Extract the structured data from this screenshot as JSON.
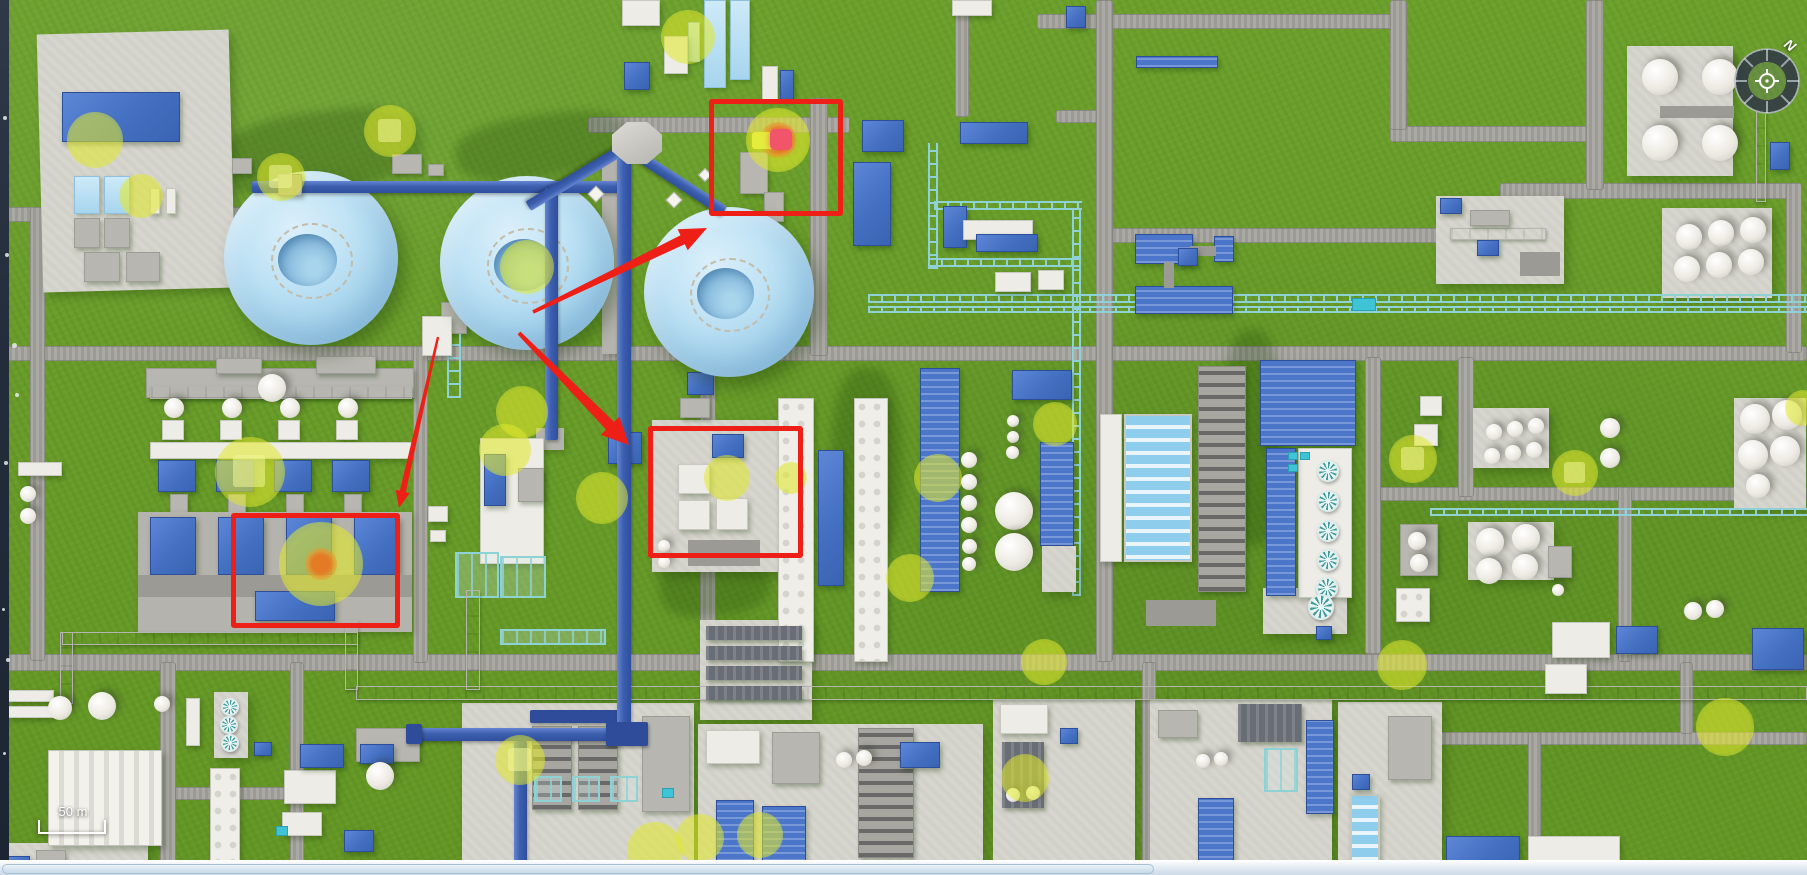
{
  "map": {
    "scale": {
      "label": "50 m"
    },
    "compass": {
      "north_label": "N"
    }
  },
  "colors": {
    "annotation_red": "#ee1f16",
    "sensor_yellow": "#e0e82c",
    "alarm_orange": "#ec731e",
    "alarm_core_red": "#f0556a",
    "sphere_blue": "#a3d2ec",
    "building_blue": "#4470c2",
    "grass_green": "#689b2b"
  },
  "annotations": {
    "rects": [
      {
        "x": 709,
        "y": 99,
        "w": 134,
        "h": 117
      },
      {
        "x": 648,
        "y": 426,
        "w": 155,
        "h": 132
      },
      {
        "x": 231,
        "y": 513,
        "w": 169,
        "h": 115
      }
    ],
    "arrows": [
      {
        "x1": 533,
        "y1": 312,
        "x2": 707,
        "y2": 228,
        "w": 8
      },
      {
        "x1": 519,
        "y1": 333,
        "x2": 629,
        "y2": 445,
        "w": 9
      },
      {
        "x1": 438,
        "y1": 337,
        "x2": 399,
        "y2": 508,
        "w": 5
      }
    ]
  },
  "alarms": [
    {
      "x": 778,
      "y": 140,
      "r": 32,
      "orange_r": 18,
      "core": "red",
      "bar": true
    },
    {
      "x": 321,
      "y": 564,
      "r": 42,
      "orange_r": 16,
      "core": "orange",
      "bar": false
    }
  ],
  "sensors": [
    {
      "x": 95,
      "y": 140,
      "r": 28,
      "sq": false
    },
    {
      "x": 141,
      "y": 196,
      "r": 22,
      "sq": false
    },
    {
      "x": 281,
      "y": 177,
      "r": 24,
      "sq": true
    },
    {
      "x": 390,
      "y": 131,
      "r": 26,
      "sq": true
    },
    {
      "x": 527,
      "y": 267,
      "r": 27,
      "sq": false
    },
    {
      "x": 688,
      "y": 37,
      "r": 27,
      "sq": false
    },
    {
      "x": 250,
      "y": 472,
      "r": 35,
      "sq": true
    },
    {
      "x": 522,
      "y": 412,
      "r": 26,
      "sq": false
    },
    {
      "x": 505,
      "y": 450,
      "r": 26,
      "sq": false
    },
    {
      "x": 602,
      "y": 498,
      "r": 26,
      "sq": false
    },
    {
      "x": 727,
      "y": 478,
      "r": 23,
      "sq": false
    },
    {
      "x": 791,
      "y": 478,
      "r": 16,
      "sq": false
    },
    {
      "x": 938,
      "y": 478,
      "r": 24,
      "sq": false
    },
    {
      "x": 1055,
      "y": 424,
      "r": 22,
      "sq": false
    },
    {
      "x": 910,
      "y": 578,
      "r": 24,
      "sq": false
    },
    {
      "x": 1044,
      "y": 662,
      "r": 23,
      "sq": false
    },
    {
      "x": 1402,
      "y": 665,
      "r": 25,
      "sq": false
    },
    {
      "x": 1025,
      "y": 778,
      "r": 24,
      "sq": false
    },
    {
      "x": 520,
      "y": 760,
      "r": 25,
      "sq": true
    },
    {
      "x": 655,
      "y": 850,
      "r": 28,
      "sq": false
    },
    {
      "x": 700,
      "y": 838,
      "r": 24,
      "sq": false
    },
    {
      "x": 760,
      "y": 835,
      "r": 23,
      "sq": false
    },
    {
      "x": 1413,
      "y": 459,
      "r": 24,
      "sq": true
    },
    {
      "x": 1575,
      "y": 473,
      "r": 23,
      "sq": true
    },
    {
      "x": 1725,
      "y": 727,
      "r": 29,
      "sq": false
    },
    {
      "x": 1803,
      "y": 408,
      "r": 18,
      "sq": false
    }
  ]
}
